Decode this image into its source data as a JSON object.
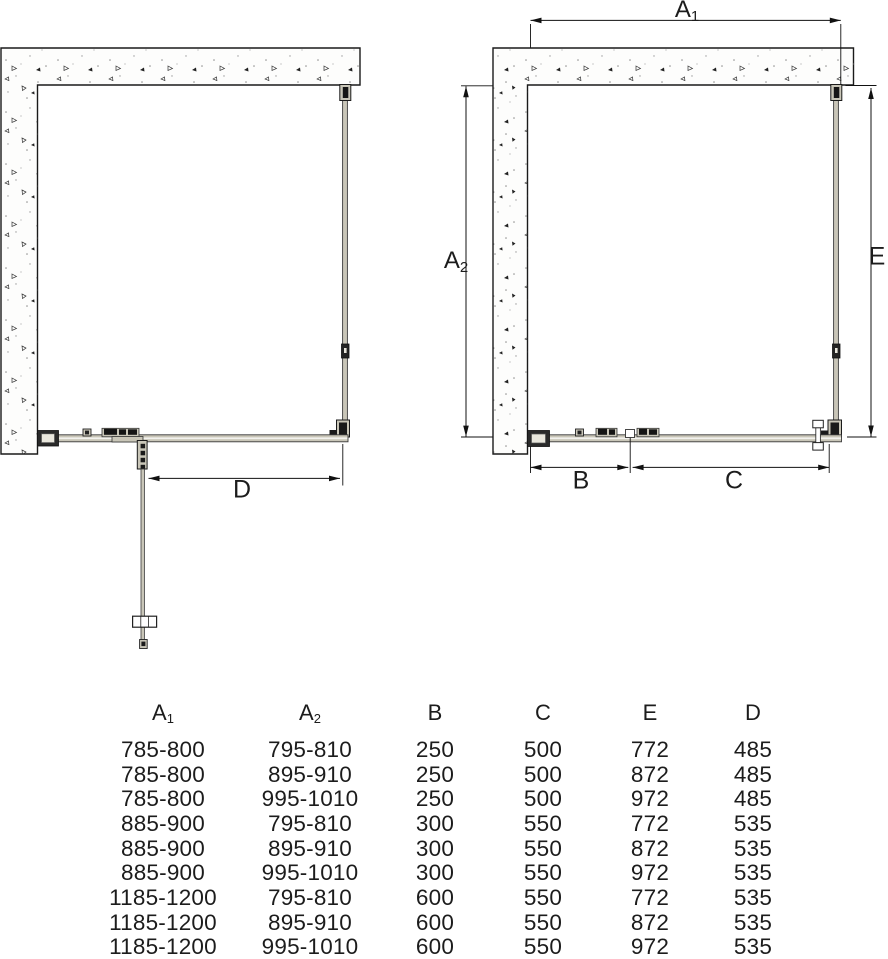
{
  "title": "shower-enclosure-installation-drawing",
  "labels": {
    "a1_base": "A",
    "a1_sub": "1",
    "a2_base": "A",
    "a2_sub": "2",
    "b": "B",
    "c": "C",
    "d": "D",
    "e": "E"
  },
  "colors": {
    "line": "#1a1a1a",
    "profile_fill": "#c9c6b8",
    "wall_fill": "#fdfdfc",
    "background": "#ffffff"
  },
  "table": {
    "headers": [
      {
        "base": "A",
        "sub": "1"
      },
      {
        "base": "A",
        "sub": "2"
      },
      {
        "base": "B",
        "sub": ""
      },
      {
        "base": "C",
        "sub": ""
      },
      {
        "base": "E",
        "sub": ""
      },
      {
        "base": "D",
        "sub": ""
      }
    ],
    "rows": [
      [
        "785-800",
        "795-810",
        "250",
        "500",
        "772",
        "485"
      ],
      [
        "785-800",
        "895-910",
        "250",
        "500",
        "872",
        "485"
      ],
      [
        "785-800",
        "995-1010",
        "250",
        "500",
        "972",
        "485"
      ],
      [
        "885-900",
        "795-810",
        "300",
        "550",
        "772",
        "535"
      ],
      [
        "885-900",
        "895-910",
        "300",
        "550",
        "872",
        "535"
      ],
      [
        "885-900",
        "995-1010",
        "300",
        "550",
        "972",
        "535"
      ],
      [
        "1185-1200",
        "795-810",
        "600",
        "550",
        "772",
        "535"
      ],
      [
        "1185-1200",
        "895-910",
        "600",
        "550",
        "872",
        "535"
      ],
      [
        "1185-1200",
        "995-1010",
        "600",
        "550",
        "972",
        "535"
      ]
    ]
  }
}
